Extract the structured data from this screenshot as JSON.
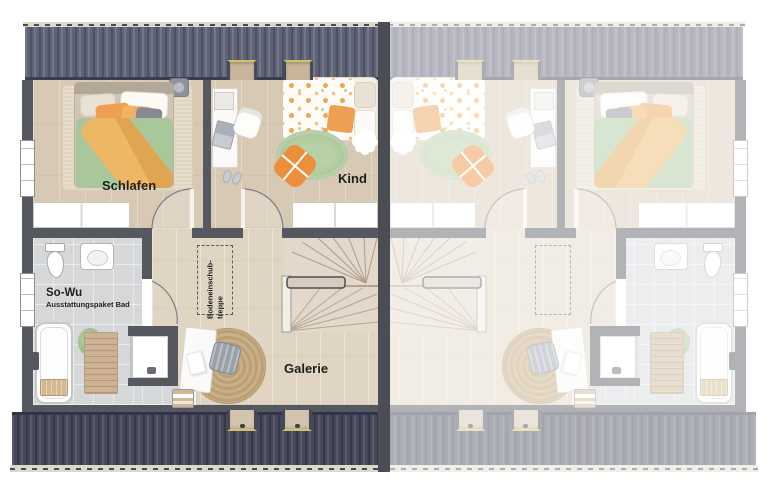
{
  "type": "floor-plan",
  "rooms": {
    "schlafen": {
      "label": "Schlafen"
    },
    "kind": {
      "label": "Kind"
    },
    "bad": {
      "label": "So-Wu",
      "sublabel": "Ausstattungspaket Bad"
    },
    "galerie": {
      "label": "Galerie"
    },
    "loft_hatch": {
      "label_line1": "Bodeneinschub-",
      "label_line2": "treppe"
    }
  },
  "colors": {
    "roof_top": "#5f6377",
    "roof_stripe_light": "rgba(255,255,255,0.13)",
    "roof_stripe_dark": "rgba(0,0,0,0.18)",
    "roof_bottom": "#45485a",
    "gutter": "#dcd9cb",
    "wall": "#56585f",
    "party_wall": "#4b4d55",
    "wood": "#d8c9b5",
    "wood_light": "#e0d4c3",
    "tile": "#d5d7d9",
    "tile_line": "#e9eaec",
    "duvet_green": "#a9c79a",
    "rug_green": "#b7d0a5",
    "rug_jute": "#c8ad82",
    "accent_orange": "#eda052",
    "accent_orange_deep": "#ec8f3c",
    "cream": "#e9e2d2",
    "label_text": "#1e1e1e",
    "fade": "rgba(255,255,255,0.55)"
  }
}
